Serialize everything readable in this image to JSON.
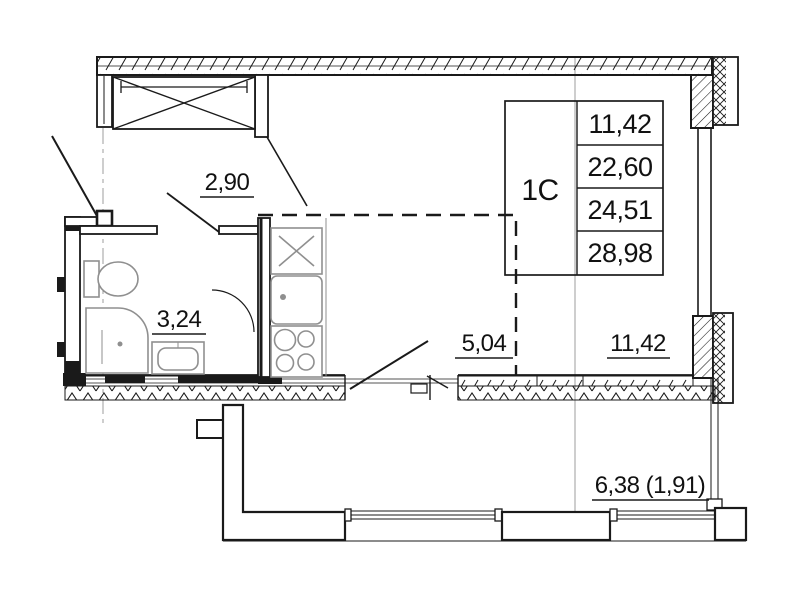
{
  "unit": {
    "type_label": "1C",
    "area_rows": [
      "11,42",
      "22,60",
      "24,51",
      "28,98"
    ]
  },
  "room_labels": {
    "hallway": "2,90",
    "bathroom": "3,24",
    "kitchen_zone": "5,04",
    "living_zone": "11,42",
    "balcony": "6,38 (1,91)"
  },
  "colors": {
    "line": "#1a1a1a",
    "fixture": "#8f8f8f",
    "axis": "#9c9c9c",
    "background": "#ffffff"
  }
}
